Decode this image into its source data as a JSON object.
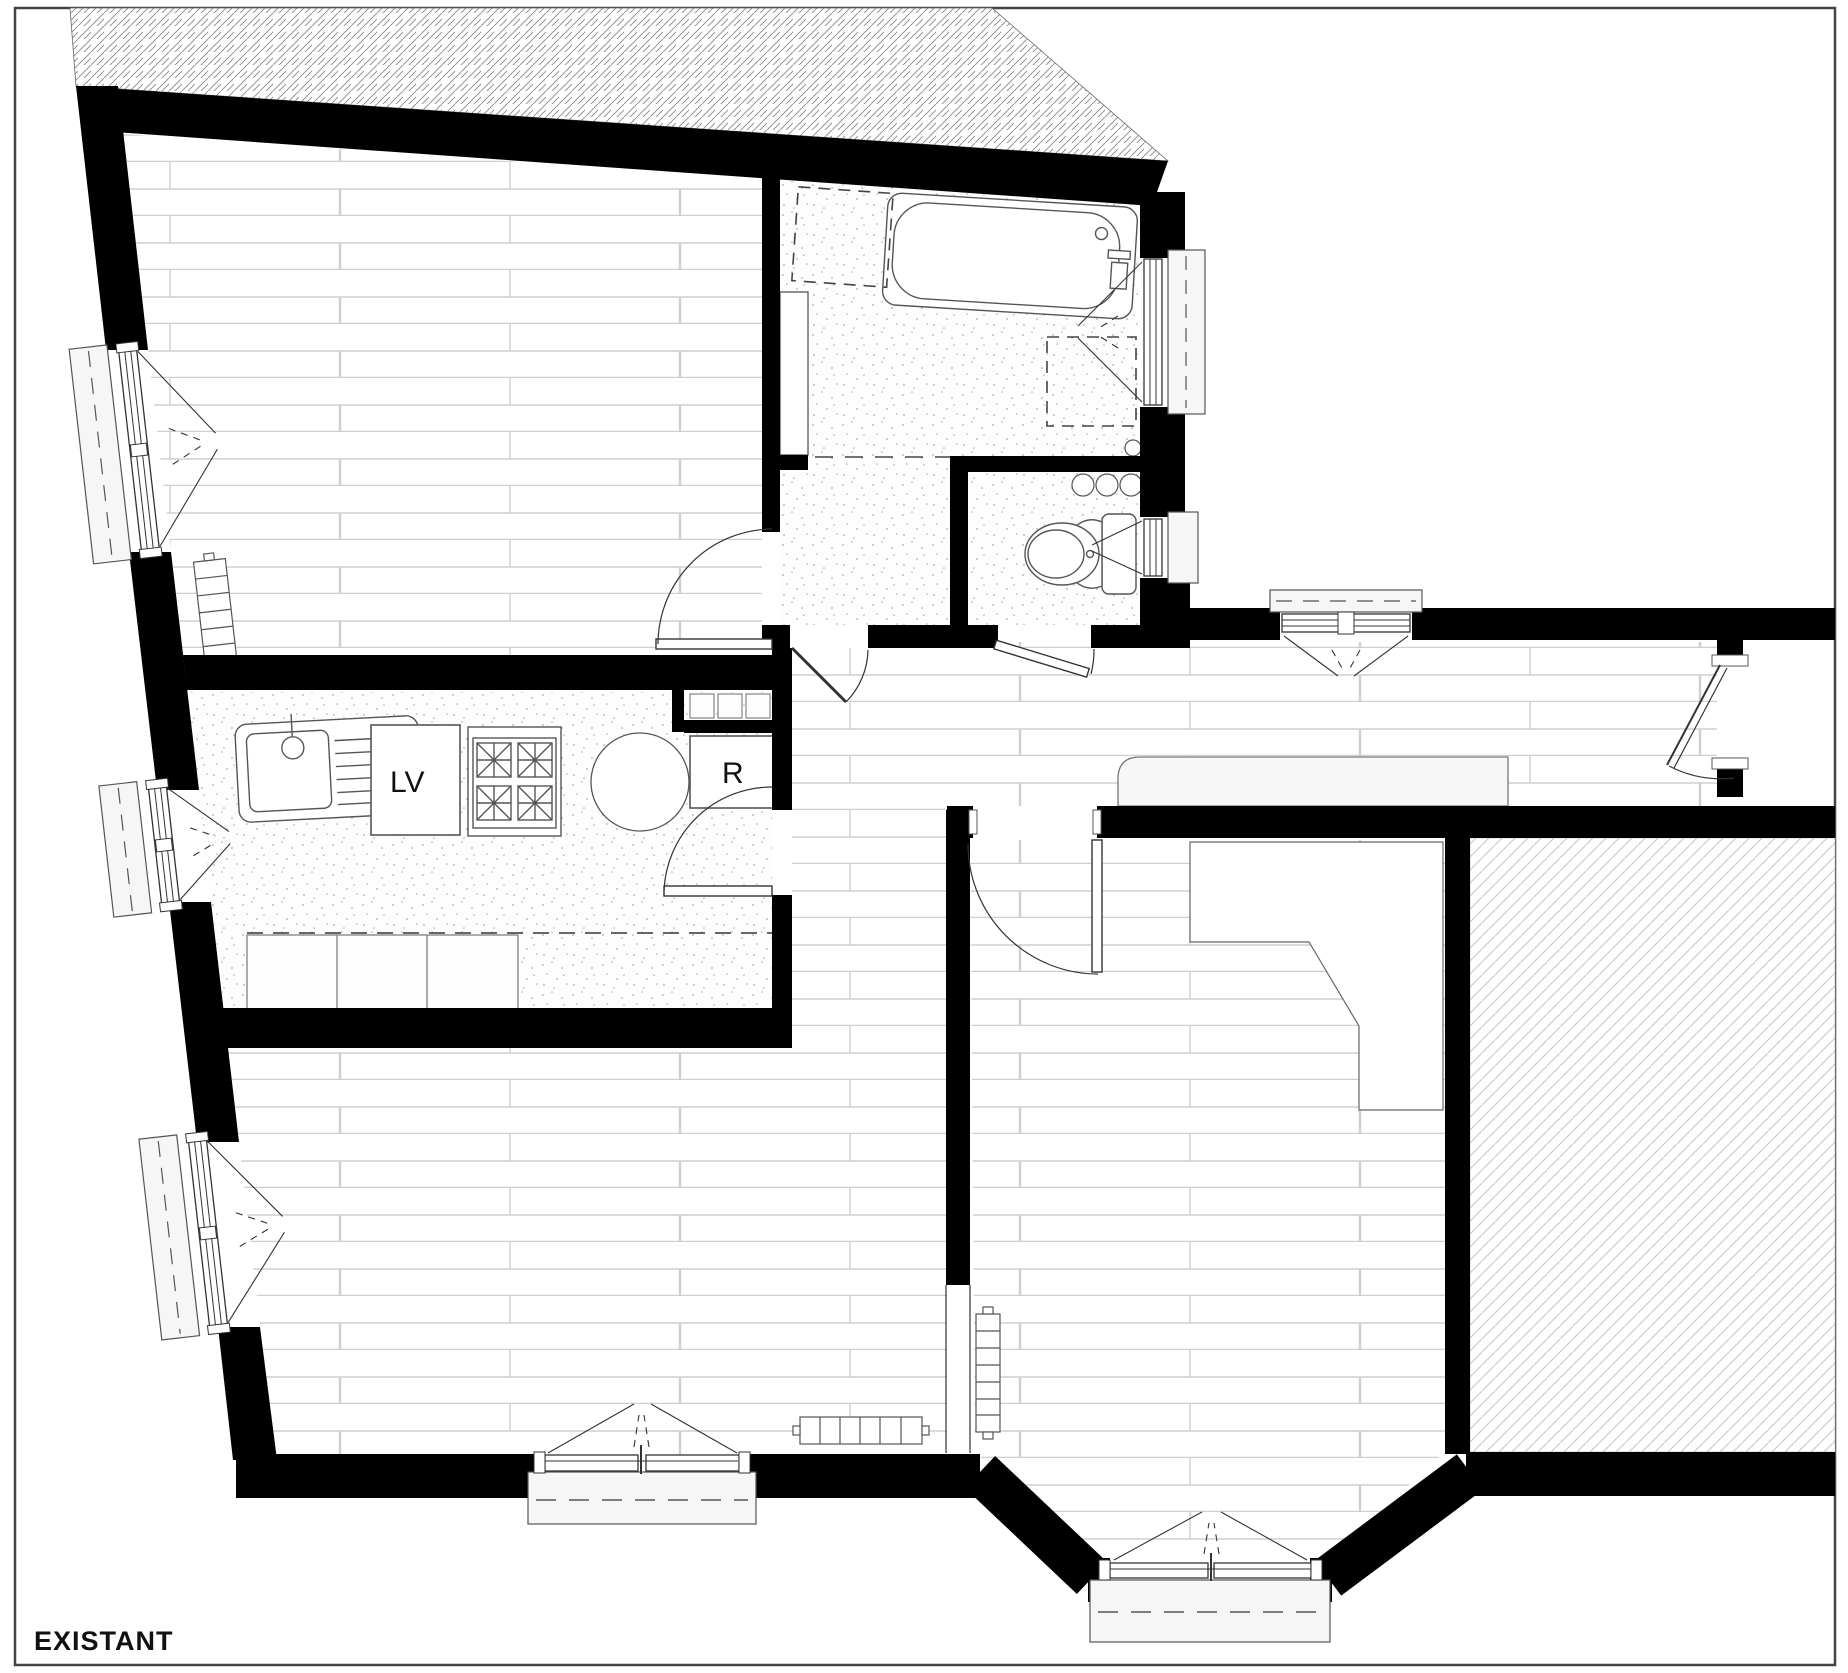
{
  "page": {
    "title": "EXISTANT"
  },
  "kitchen": {
    "dishwasher": "LV",
    "fridge": "R"
  },
  "colors": {
    "wall": "#000000",
    "plank_line": "#cfcfcf",
    "stipple_dot": "#aaaaaa",
    "neighbor_hatch": "#8a8a8a",
    "storage_room_hatch": "#c4c4c4",
    "fixture_stroke": "#555555",
    "sill_fill": "#f6f6f6",
    "label": "#111111"
  },
  "icons": [
    "bathtub-icon",
    "toilet-icon",
    "kitchen-sink-icon",
    "stove-icon",
    "dishwasher-icon",
    "fridge-icon",
    "radiator-icon",
    "casement-window-icon",
    "door-swing-icon",
    "washing-machine-outline-icon",
    "round-table-icon",
    "pipe-duct-icon"
  ]
}
